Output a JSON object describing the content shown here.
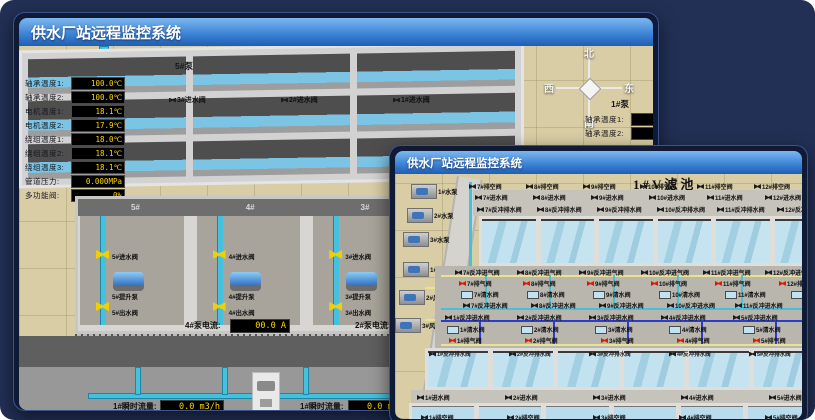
{
  "colors": {
    "accent_blue": "#3f85d6",
    "tan_floor": "#d9cda5",
    "pipe_cyan": "#45c0dd",
    "pipe_air_yellow": "#e9e391",
    "pipe_blue": "#2a3bd0",
    "valve_yellow": "#f2cf00",
    "valve_red": "#d81f00",
    "readout_bg": "#000000",
    "readout_text": "#ffd700"
  },
  "pump_window": {
    "title": "供水厂站远程监控系统",
    "room_title": "取水泵房",
    "compass": {
      "n": "北",
      "s": "南",
      "w": "西",
      "e": "东"
    },
    "pump5_panel": {
      "title": "5#泵",
      "rows": [
        {
          "label": "轴承温度1:",
          "value": "100.0℃"
        },
        {
          "label": "轴承温度2:",
          "value": "100.0℃"
        },
        {
          "label": "电机温度1:",
          "value": "18.1℃"
        },
        {
          "label": "电机温度2:",
          "value": "17.9℃"
        },
        {
          "label": "绕组温度1:",
          "value": "18.0℃"
        },
        {
          "label": "绕组温度2:",
          "value": "18.1℃"
        },
        {
          "label": "绕组温度3:",
          "value": "18.1℃"
        },
        {
          "label": "管道压力:",
          "value": "0.000MPa"
        },
        {
          "label": "多功能阀:",
          "value": "0%"
        }
      ]
    },
    "pump1_panel": {
      "title": "1#泵",
      "rows": [
        {
          "label": "轴承温度1:"
        },
        {
          "label": "轴承温度2:"
        }
      ]
    },
    "intake_valve_labels": [
      "3#进水阀",
      "2#进水阀",
      "1#进水阀"
    ],
    "bays": [
      {
        "no": "5#",
        "inlet": "5#进水阀",
        "pump": "5#提升泵",
        "outlet": "5#出水阀"
      },
      {
        "no": "4#",
        "inlet": "4#进水阀",
        "pump": "4#提升泵",
        "outlet": "4#出水阀"
      },
      {
        "no": "3#",
        "inlet": "3#进水阀",
        "pump": "3#提升泵",
        "outlet": "3#出水阀"
      },
      {
        "no": "2#",
        "inlet": "2#进水阀",
        "pump": "2#提升泵",
        "outlet": "2#出水阀"
      },
      {
        "no": "1#",
        "inlet": "1#进水阀",
        "pump": "1#提升泵",
        "outlet": "1#出水阀"
      }
    ],
    "current4": {
      "label": "4#泵电流:",
      "value": "00.0 A"
    },
    "current2": {
      "label": "2#泵电流:",
      "value": "00.0 A"
    },
    "flow1": {
      "label": "1#瞬时流量:",
      "value": "0.0 m3/h"
    },
    "flow2": {
      "label": "1#瞬时流量:",
      "value": "0.0 m3/h"
    }
  },
  "filter_window": {
    "title": "供水厂站远程监控系统",
    "room_title": "1#V滤池",
    "pumps": [
      "1#水泵",
      "2#水泵",
      "3#水泵"
    ],
    "blowers": [
      "1#风机",
      "2#风机",
      "3#风机"
    ],
    "top": {
      "empty": [
        "7#排空阀",
        "8#排空阀",
        "9#排空阀",
        "10#排空阀",
        "11#排空阀",
        "12#排空阀"
      ],
      "inlet": [
        "7#进水阀",
        "8#进水阀",
        "9#进水阀",
        "10#进水阀",
        "11#进水阀",
        "12#进水阀"
      ],
      "backwash_drain": [
        "7#反冲排水阀",
        "8#反冲排水阀",
        "9#反冲排水阀",
        "10#反冲排水阀",
        "11#反冲排水阀",
        "12#反冲排水阀"
      ],
      "air_inlet": [
        "7#反冲进气阀",
        "8#反冲进气阀",
        "9#反冲进气阀",
        "10#反冲进气阀",
        "11#反冲进气阀",
        "12#反冲进气阀"
      ],
      "air_release": [
        "7#排气阀",
        "8#排气阀",
        "9#排气阀",
        "10#排气阀",
        "11#排气阀",
        "12#排气阀"
      ],
      "clean": [
        "7#清水阀",
        "8#清水阀",
        "9#清水阀",
        "10#清水阀",
        "11#清水阀",
        "12#清水阀"
      ],
      "backwash_inlet": [
        "7#反冲进水阀",
        "8#反冲进水阀",
        "9#反冲进水阀",
        "10#反冲进水阀",
        "11#反冲进水阀",
        "12#反冲进水阀"
      ]
    },
    "bottom": {
      "backwash_inlet": [
        "1#反冲进水阀",
        "2#反冲进水阀",
        "3#反冲进水阀",
        "4#反冲进水阀",
        "5#反冲进水阀",
        "6#反冲进水阀"
      ],
      "clean": [
        "1#清水阀",
        "2#清水阀",
        "3#清水阀",
        "4#清水阀",
        "5#清水阀",
        "6#清水阀"
      ],
      "air_release": [
        "1#排气阀",
        "2#排气阀",
        "3#排气阀",
        "4#排气阀",
        "5#排气阀",
        "6#排气阀"
      ],
      "backwash_drain": [
        "1#反冲排水阀",
        "2#反冲排水阀",
        "3#反冲排水阀",
        "4#反冲排水阀",
        "5#反冲排水阀",
        "6#反冲排水阀"
      ],
      "inlet": [
        "1#进水阀",
        "2#进水阀",
        "3#进水阀",
        "4#进水阀",
        "5#进水阀",
        "6#进水阀"
      ],
      "empty": [
        "1#排空阀",
        "2#排空阀",
        "3#排空阀",
        "4#排空阀",
        "5#排空阀",
        "6#排空阀"
      ]
    }
  }
}
